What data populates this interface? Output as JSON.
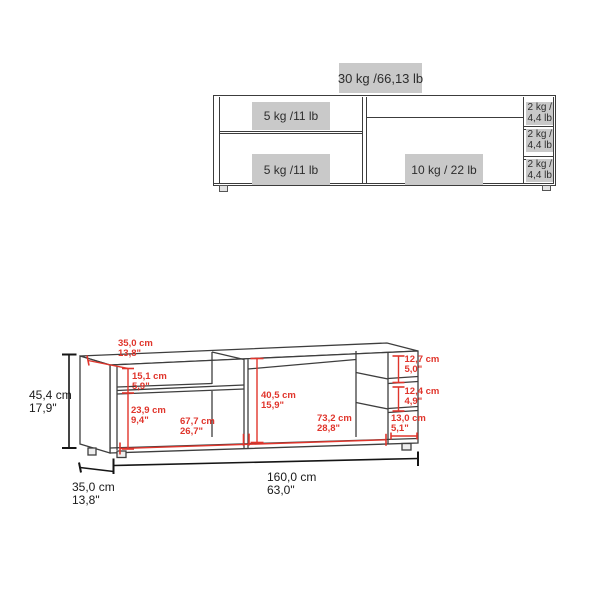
{
  "colors": {
    "dimension_red": "#e0352c",
    "label_box_gray": "#c9c9c9",
    "cabinet_line": "#3c3c3c",
    "dimension_black": "#1a1a1a"
  },
  "front_view": {
    "total_capacity": "30 kg /66,13 lb",
    "left_top_shelf_capacity": "5 kg /11 lb",
    "left_bottom_shelf_capacity": "5 kg /11 lb",
    "center_section_capacity": "10 kg / 22 lb",
    "side_compartments": [
      {
        "line1": "2 kg /",
        "line2": "4,4 lb"
      },
      {
        "line1": "2 kg /",
        "line2": "4,4 lb"
      },
      {
        "line1": "2 kg /",
        "line2": "4,4 lb"
      }
    ]
  },
  "dimension_view": {
    "top_depth": {
      "cm": "35,0 cm",
      "inch": "13,8\""
    },
    "left_top_opening": {
      "cm": "15,1 cm",
      "inch": "5,9\""
    },
    "left_bottom_opening": {
      "cm": "23,9 cm",
      "inch": "9,4\""
    },
    "left_section_width": {
      "cm": "67,7 cm",
      "inch": "26,7\""
    },
    "center_opening_height": {
      "cm": "40,5 cm",
      "inch": "15,9\""
    },
    "center_section_width": {
      "cm": "73,2 cm",
      "inch": "28,8\""
    },
    "side_top_compartment": {
      "cm": "12,7 cm",
      "inch": "5,0\""
    },
    "side_middle_compartment": {
      "cm": "12,4 cm",
      "inch": "4,9\""
    },
    "side_bottom_compartment": {
      "cm": "13,0 cm",
      "inch": "5,1\""
    },
    "overall_height": {
      "cm": "45,4 cm",
      "inch": "17,9\""
    },
    "overall_width": {
      "cm": "160,0 cm",
      "inch": "63,0\""
    },
    "base_depth": {
      "cm": "35,0 cm",
      "inch": "13,8\""
    }
  }
}
